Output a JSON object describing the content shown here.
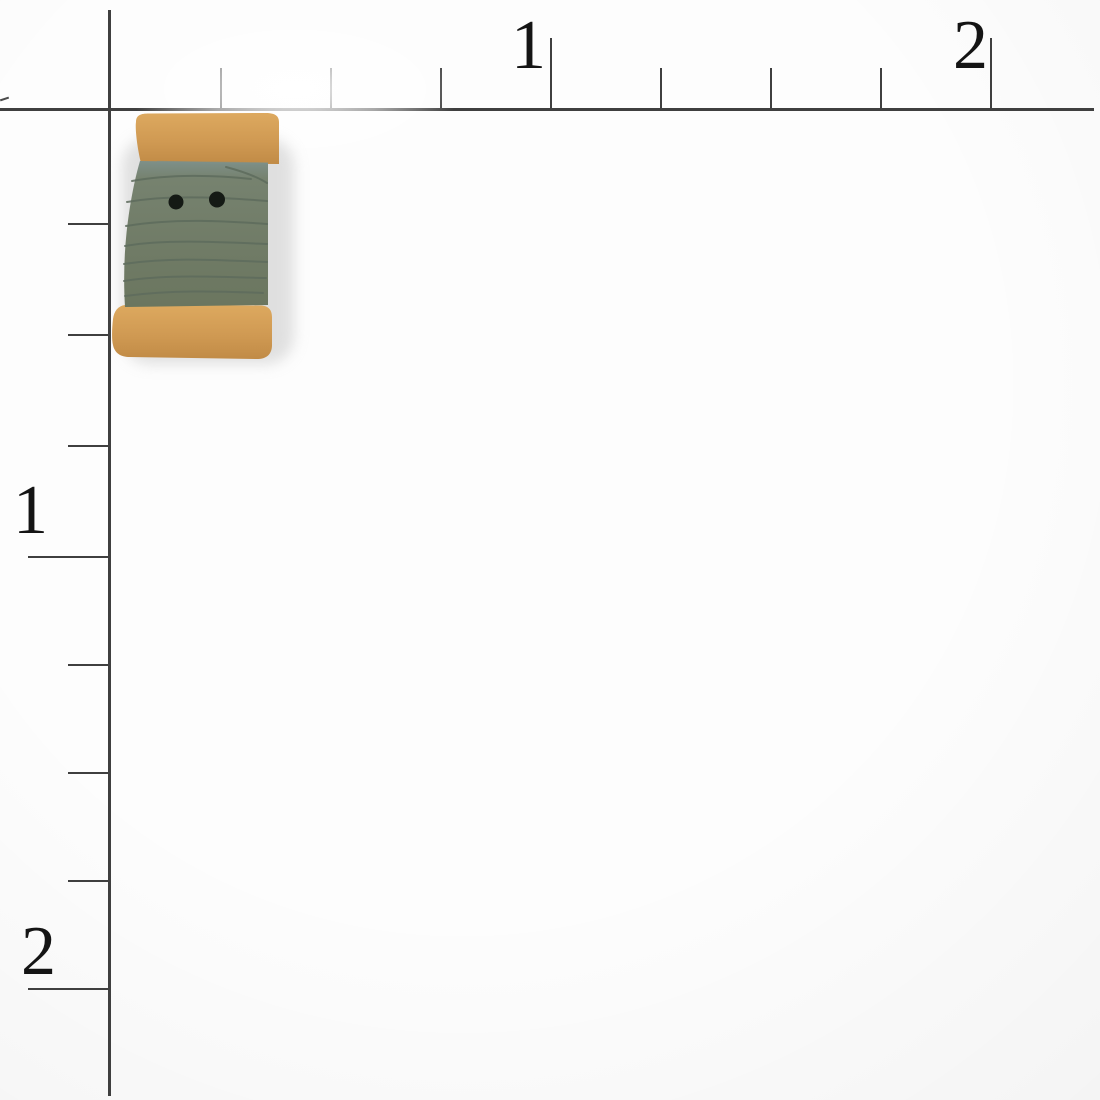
{
  "scene": {
    "type": "product-photo",
    "subject": "handmade ceramic spool-of-thread button photographed on an inch ruler grid",
    "background_color": "#fdfdfd"
  },
  "ruler": {
    "line_color": "#3f3f3f",
    "label_color": "#141414",
    "top": {
      "labels": [
        {
          "text": "1",
          "tick_x": 550
        },
        {
          "text": "2",
          "tick_x": 990
        }
      ],
      "minor_ticks_x": [
        220,
        330,
        440,
        660,
        770,
        880
      ],
      "major_ticks_x": [
        550,
        990
      ]
    },
    "left": {
      "labels": [
        {
          "text": "1",
          "tick_y": 556
        },
        {
          "text": "2",
          "tick_y": 988
        }
      ],
      "minor_ticks_y": [
        223,
        334,
        445,
        664,
        772,
        880
      ],
      "major_ticks_y": [
        556,
        988
      ]
    }
  },
  "button": {
    "name": "green-spool-button",
    "hole_count": 2,
    "flange_color_top": "#dda95f",
    "flange_color": "#d09a53",
    "flange_color_deep": "#c18b46",
    "thread_tint_color": "#7e9089",
    "thread_color": "#76826f",
    "thread_color_dark": "#6b765f",
    "thread_line_color": "#5e6c5d",
    "hole_color": "#151a15",
    "shadow_color": "#c2c2c2"
  }
}
